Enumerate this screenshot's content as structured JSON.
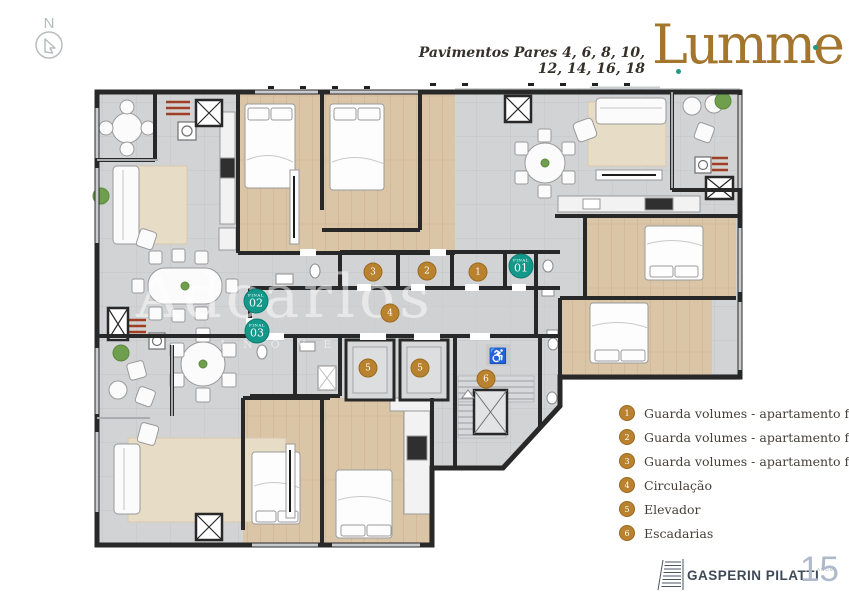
{
  "header": {
    "floors_label": "Pavimentos Pares 4, 6, 8, 10, 12, 14, 16, 18",
    "brand_name": "Lumme"
  },
  "compass": {
    "north_label": "N"
  },
  "watermark": {
    "name": "Adcarlos",
    "tagline": "INOVE"
  },
  "plan": {
    "storage_badges": [
      {
        "label": "3"
      },
      {
        "label": "2"
      },
      {
        "label": "1"
      }
    ],
    "circulation_badge": {
      "label": "4"
    },
    "elevator_badges": [
      {
        "label": "5"
      },
      {
        "label": "5"
      }
    ],
    "stairs_badge": {
      "label": "6"
    },
    "unit_badges": [
      {
        "sublabel": "final",
        "label": "01"
      },
      {
        "sublabel": "final",
        "label": "02"
      },
      {
        "sublabel": "final",
        "label": "03"
      }
    ],
    "accessibility_icon": "♿"
  },
  "legend": {
    "items": [
      {
        "num": "1",
        "label": "Guarda volumes - apartamento final 01"
      },
      {
        "num": "2",
        "label": "Guarda volumes - apartamento final 02"
      },
      {
        "num": "3",
        "label": "Guarda volumes - apartamento final 03"
      },
      {
        "num": "4",
        "label": "Circulação"
      },
      {
        "num": "5",
        "label": "Elevador"
      },
      {
        "num": "6",
        "label": "Escadarias"
      }
    ]
  },
  "footer": {
    "company": "GASPERIN PILATTI",
    "years_number": "15",
    "years_label": "ANOS"
  },
  "colors": {
    "accent_gold": "#b9822f",
    "accent_teal": "#13988a",
    "brand_gold": "#a3752d",
    "wall": "#282828",
    "wood_floor": "#dbc5a7",
    "tile_floor": "#d2d3d5"
  }
}
